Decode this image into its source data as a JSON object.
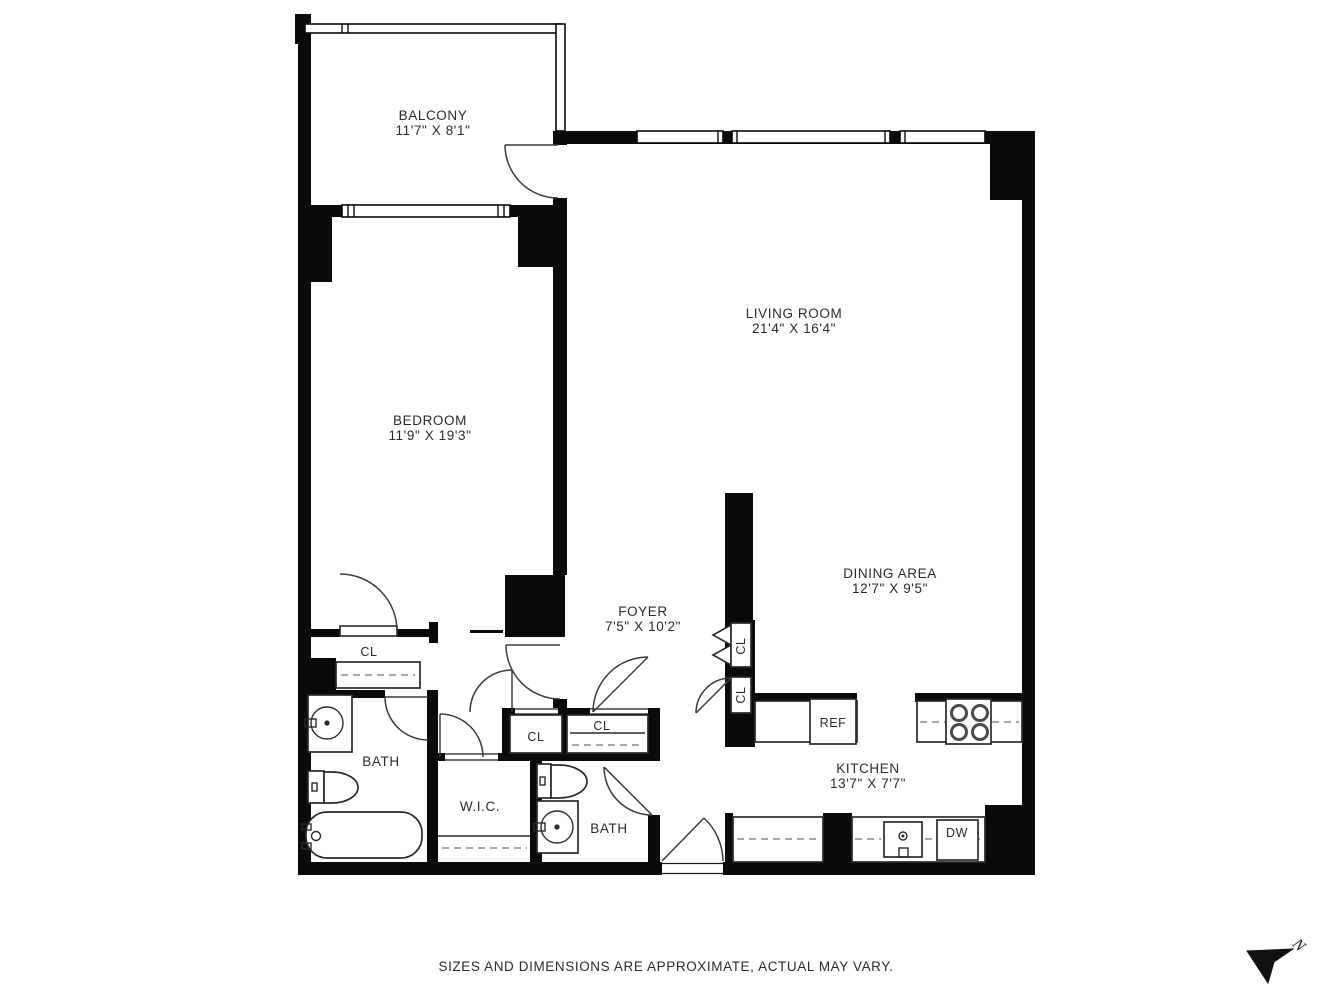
{
  "plan": {
    "rooms": [
      {
        "name": "BALCONY",
        "dims": "11'7\" X 8'1\""
      },
      {
        "name": "LIVING ROOM",
        "dims": "21'4\" X 16'4\""
      },
      {
        "name": "BEDROOM",
        "dims": "11'9\" X 19'3\""
      },
      {
        "name": "DINING AREA",
        "dims": "12'7\" X 9'5\""
      },
      {
        "name": "FOYER",
        "dims": "7'5\" X 10'2\""
      },
      {
        "name": "KITCHEN",
        "dims": "13'7\" X 7'7\""
      }
    ],
    "small_rooms": [
      {
        "name": "BATH"
      },
      {
        "name": "BATH"
      },
      {
        "name": "W.I.C."
      }
    ],
    "closets": [
      "CL",
      "CL",
      "CL",
      "CL",
      "CL"
    ],
    "appliances": {
      "refrigerator": "REF",
      "dishwasher": "DW"
    },
    "north_label": "N",
    "footer": "SIZES AND DIMENSIONS ARE APPROXIMATE, ACTUAL MAY VARY."
  }
}
